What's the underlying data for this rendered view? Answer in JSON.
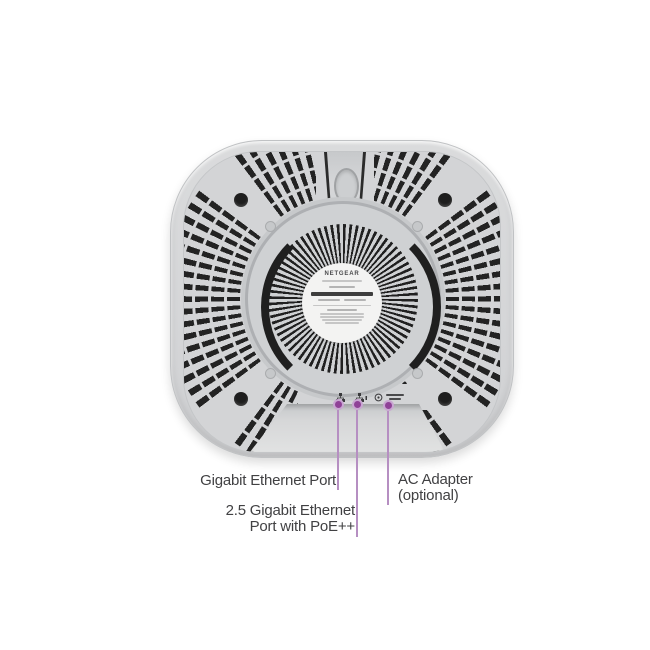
{
  "page": {
    "type": "product-annotation-diagram",
    "background": "#ffffff",
    "subject": "Bottom view of a NETGEAR wireless access point showing port locations"
  },
  "device": {
    "name": "access-point-bottom-view",
    "label_brand": "NETGEAR",
    "port_icons": [
      {
        "name": "gigabit-lan-icon"
      },
      {
        "name": "poe-lan-icon"
      },
      {
        "name": "dc-power-icon"
      },
      {
        "name": "power-rating-marks"
      }
    ]
  },
  "callouts": [
    {
      "name": "gigabit-ethernet-port",
      "lines": [
        "Gigabit Ethernet Port"
      ]
    },
    {
      "name": "poe-ethernet-port",
      "lines": [
        "2.5 Gigabit Ethernet",
        "Port with PoE++"
      ]
    },
    {
      "name": "ac-adapter",
      "lines": [
        "AC Adapter",
        "(optional)"
      ]
    }
  ],
  "colors": {
    "body_gray": "#d3d4d6",
    "vent_black": "#232323",
    "callout_line": "#b68fc2",
    "callout_dot": "#8f4197",
    "label_text": "#414143"
  }
}
